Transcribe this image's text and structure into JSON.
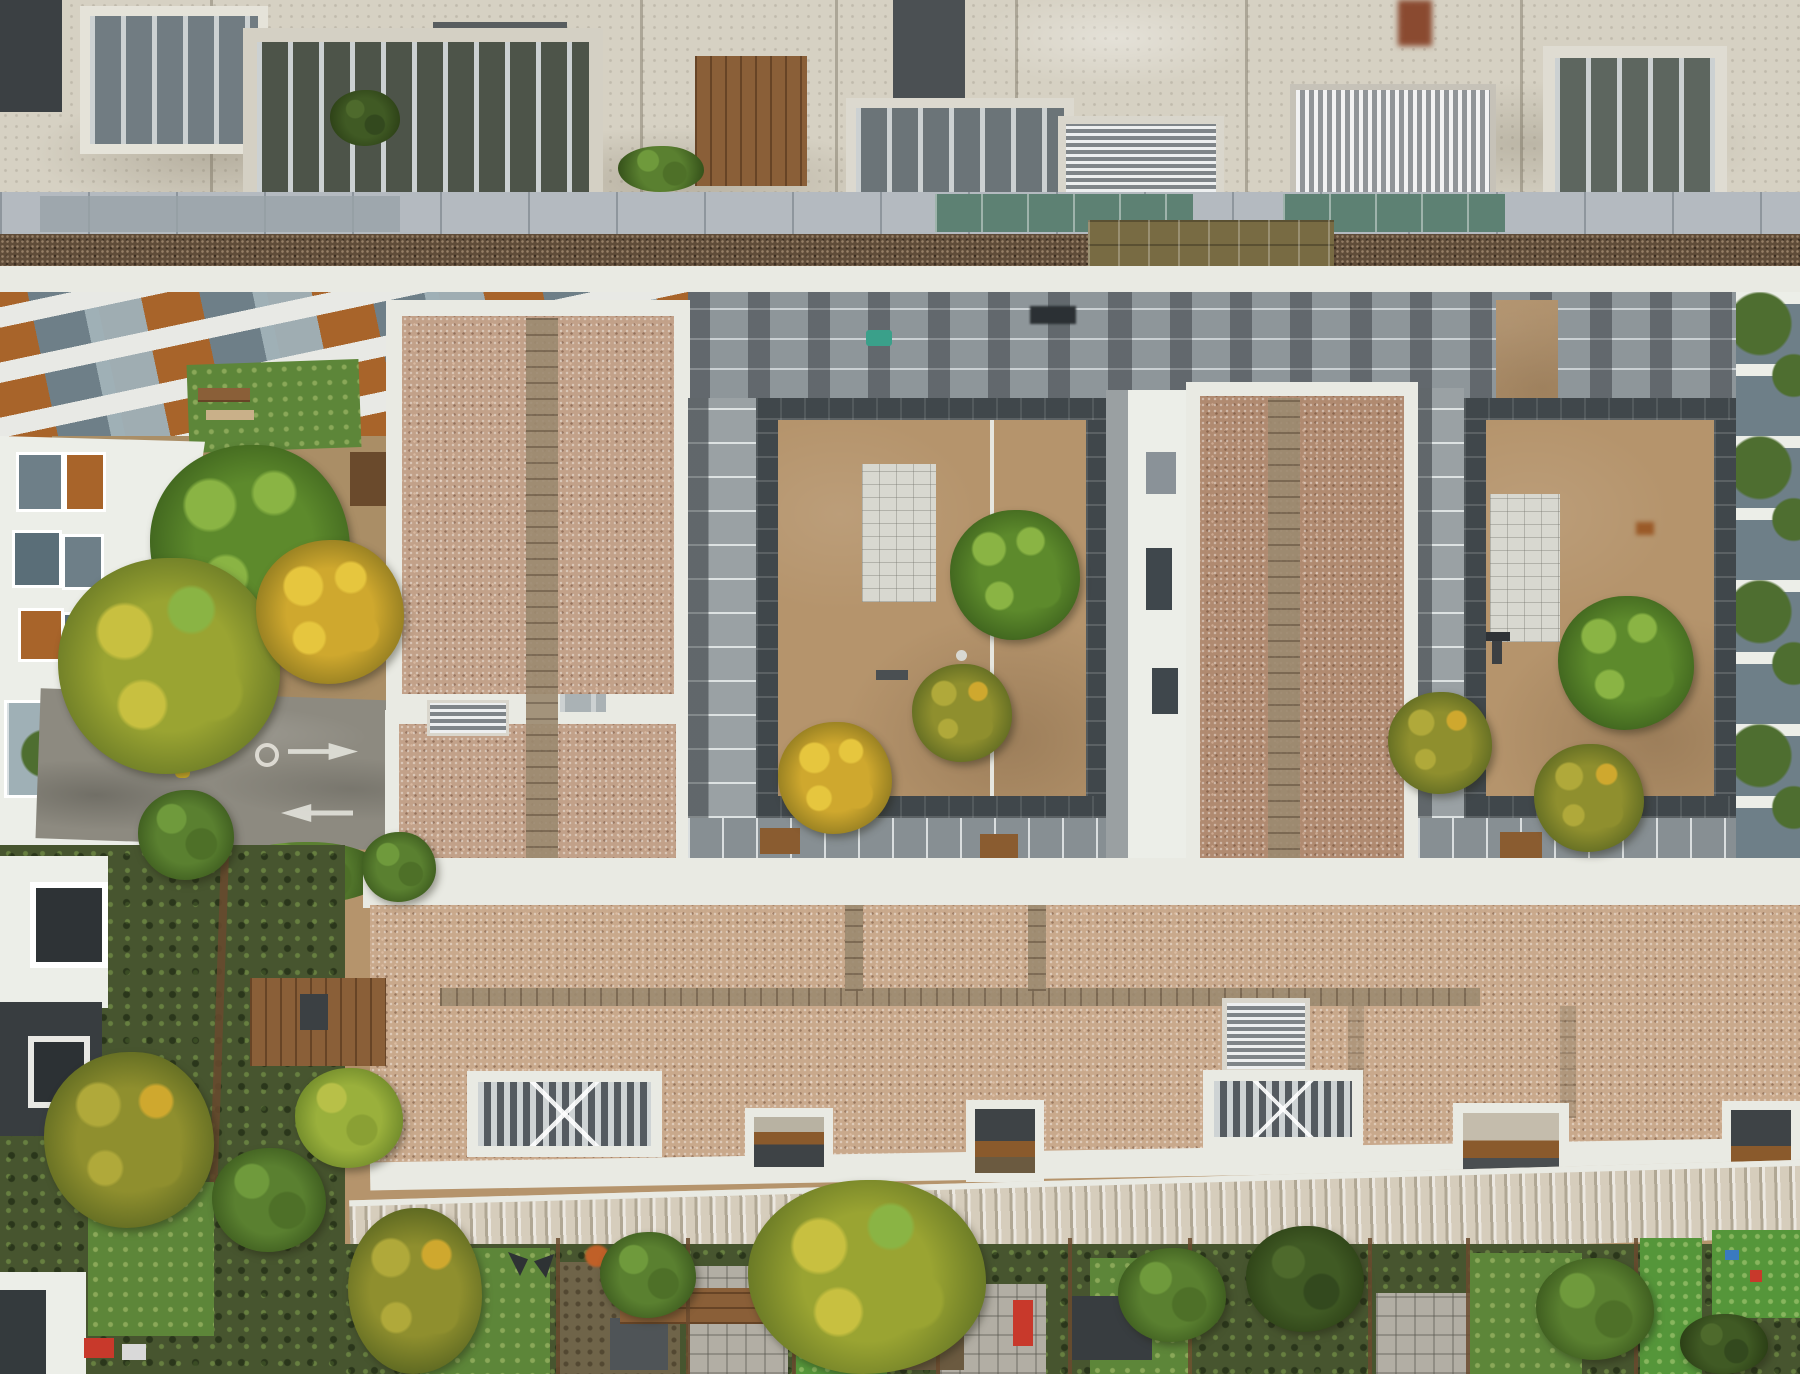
{
  "scene": {
    "type": "aerial-photograph",
    "description": "Top-down drone photograph of a modern residential apartment complex: aged white concrete rooftop with barred plant-room openings along the top, a strip of glass skylights and brown sedum roof, a diagonal terraced facade with orange and glass panels, two tan courtyards with autumn trees and white paved rectangles, pink gravel flat roofs with paver paths and white parapets, a small access road with painted arrows and yellow-black speed humps, white slatted pergola grilles, a beige corrugated eaves band, and terraced back gardens with lawns, sheds, fences and trees along the bottom.",
    "regions": [
      {
        "name": "top-roof-band",
        "label": "aged concrete rooftop with plant rooms"
      },
      {
        "name": "roof-grille-1",
        "label": "barred plant-room opening"
      },
      {
        "name": "roof-grille-2",
        "label": "barred lightwell with planting"
      },
      {
        "name": "roof-grille-3",
        "label": "barred plant-room opening"
      },
      {
        "name": "roof-grille-4",
        "label": "barred plant-room opening"
      },
      {
        "name": "roof-louvre-vent",
        "label": "metal louvre vent"
      },
      {
        "name": "roof-corrugated-vent",
        "label": "corrugated metal vent"
      },
      {
        "name": "roof-wood-deck",
        "label": "small timber roof terrace"
      },
      {
        "name": "skylight-band",
        "label": "walkway with glass skylight strips"
      },
      {
        "name": "skylight-teal-1",
        "label": "teal glass skylight"
      },
      {
        "name": "skylight-teal-2",
        "label": "teal glass skylight"
      },
      {
        "name": "skylight-gold",
        "label": "gold-tinted glazed atrium"
      },
      {
        "name": "sedum-strip",
        "label": "brown sedum green-roof strip"
      },
      {
        "name": "terrace-facade",
        "label": "diagonal terraced facade with orange panels"
      },
      {
        "name": "west-lawn",
        "label": "small lawn with benches"
      },
      {
        "name": "west-building",
        "label": "white apartment building with balconies"
      },
      {
        "name": "west-plaza",
        "label": "tan plaza with trees"
      },
      {
        "name": "access-road",
        "label": "access road with arrows and speed humps"
      },
      {
        "name": "gravel-roof-central",
        "label": "central gravel roof with paver path"
      },
      {
        "name": "courtyard-west",
        "label": "west courtyard, tan surface"
      },
      {
        "name": "courtyard-west-paving",
        "label": "white paved rectangle"
      },
      {
        "name": "courtyard-east",
        "label": "east courtyard, tan surface"
      },
      {
        "name": "courtyard-east-paving",
        "label": "white paved rectangle"
      },
      {
        "name": "gravel-roof-east",
        "label": "east gravel roof with paver path"
      },
      {
        "name": "mid-building-strip",
        "label": "white stair/lift core between courtyards"
      },
      {
        "name": "east-balcony-strip",
        "label": "planted balconies at right edge"
      },
      {
        "name": "south-gravel-roof",
        "label": "large gravel roof with pergola grilles"
      },
      {
        "name": "pergola-grille-west",
        "label": "white slatted pergola grille"
      },
      {
        "name": "pergola-grille-east",
        "label": "white slatted pergola grille"
      },
      {
        "name": "eaves-corrugated-band",
        "label": "beige corrugated eaves band"
      },
      {
        "name": "back-gardens",
        "label": "terraced back gardens with lawns and sheds"
      },
      {
        "name": "southwest-houses",
        "label": "houses with gardens and wooden deck"
      },
      {
        "name": "tree-green-plaza",
        "label": "large green tree"
      },
      {
        "name": "tree-lime-plaza",
        "label": "yellow-green tree"
      },
      {
        "name": "tree-yellow-plaza",
        "label": "golden yellow tree"
      },
      {
        "name": "tree-green-courtyard-west",
        "label": "green tree"
      },
      {
        "name": "tree-olive-courtyard-west",
        "label": "olive-yellow tree"
      },
      {
        "name": "tree-yellow-courtyard-west",
        "label": "yellow tree"
      },
      {
        "name": "tree-green-courtyard-east",
        "label": "green tree"
      },
      {
        "name": "tree-olive-courtyard-east-1",
        "label": "olive tree"
      },
      {
        "name": "tree-olive-courtyard-east-2",
        "label": "olive tree"
      },
      {
        "name": "tree-lime-garden",
        "label": "large lime-yellow garden tree"
      }
    ]
  },
  "palette": {
    "concrete": "#d6d1c3",
    "charcoal": "#3b4043",
    "slabGray": "#585d5f",
    "parapet": "#e9eae3",
    "metalLight": "#ccd1d2",
    "walkway": "#b4bac0",
    "glassTeal": "#5d8173",
    "glassGray": "#98a2a8",
    "glassGold": "#786b43",
    "sedum": "#5f4c39",
    "facadeOrange": "#a8642a",
    "facadeGlass": "#6e7f88",
    "facadeMetal": "#9fb0b6",
    "facadeGlassL": "#9fadb2",
    "facadeWhite": "#e8e9e5",
    "gravelPink": "#c2a189",
    "gravelBrown": "#b08a70",
    "gravelBig": "#c9a98c",
    "tan": "#b5946c",
    "plaza": "#aa8e66",
    "paverTan": "#9c8a70",
    "pavedWhite": "#d8d8d0",
    "tileDark": "#40474b",
    "road": "#8d8a80",
    "roadMark": "#e8e8e0",
    "humpYellow": "#d8b62a",
    "humpBlack": "#2e2c24",
    "lawn": "#5d8639",
    "lawnBright": "#55963a",
    "gardenDark": "#47552f",
    "wood": "#8a5f38",
    "woodFence": "#6a4a2e",
    "corrugBeige": "#d6cdbc",
    "houseDark": "#383d40",
    "white": "#eceee8",
    "red": "#c8392b",
    "teal": "#3aa08a",
    "plant": "#4e6e30",
    "treeGreenL": "#8ab444",
    "treeGreenM": "#5d8a2c",
    "treeGreenD": "#3f641e",
    "treeYellowL": "#e6c63e",
    "treeYellowM": "#cfa82e",
    "treeYellowD": "#8f7a20",
    "treeOliveL": "#b0a93a",
    "treeOliveM": "#8f8f2e",
    "treeOliveD": "#5f6a22",
    "treeLimeL": "#c8c040",
    "treeLimeM": "#9aa432",
    "treeLimeD": "#6a7a26"
  }
}
